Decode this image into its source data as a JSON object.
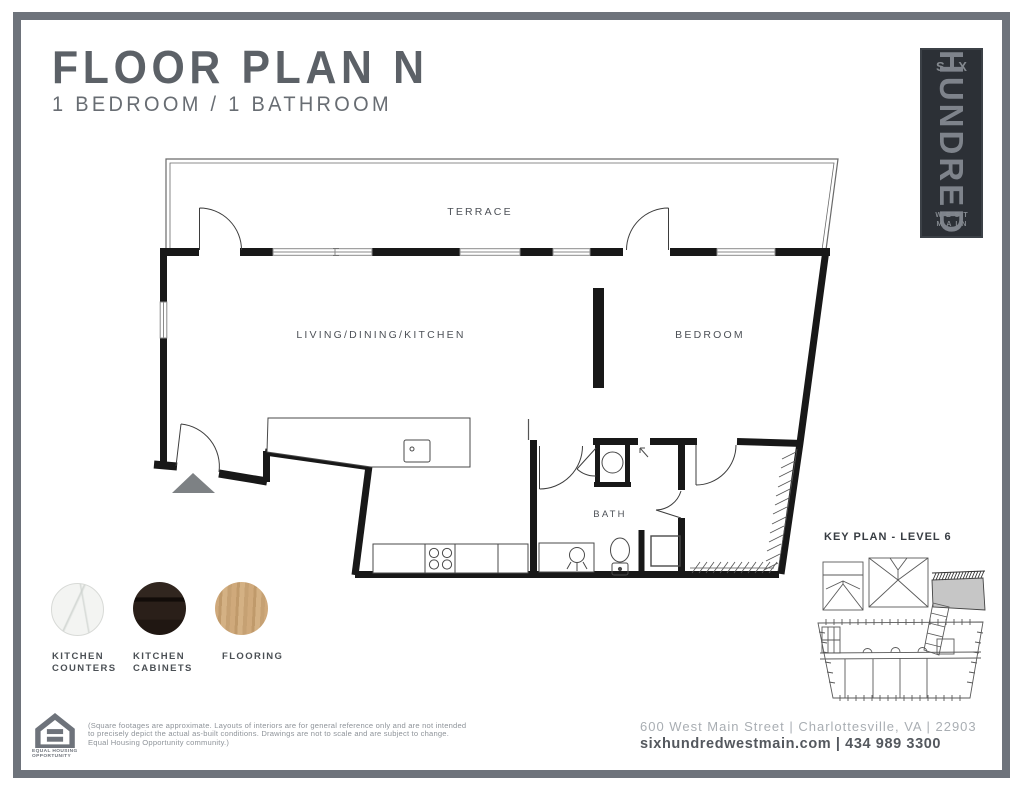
{
  "page": {
    "title": "FLOOR PLAN N",
    "subtitle": "1 BEDROOM / 1 BATHROOM"
  },
  "logo": {
    "top": "SIX",
    "middle": "HUNDRED",
    "bottom_line1": "WEST",
    "bottom_line2": "MAIN"
  },
  "plan": {
    "rooms": {
      "terrace": "TERRACE",
      "living": "LIVING/DINING/KITCHEN",
      "bedroom": "BEDROOM",
      "bath": "BATH"
    }
  },
  "key_plan": {
    "title": "KEY PLAN - LEVEL 6"
  },
  "swatches": [
    {
      "name": "kitchen-counters",
      "label_lines": [
        "KITCHEN",
        "COUNTERS"
      ],
      "color": "#f3f4f2"
    },
    {
      "name": "kitchen-cabinets",
      "label_lines": [
        "KITCHEN",
        "CABINETS"
      ],
      "color": "#241c17"
    },
    {
      "name": "flooring",
      "label_lines": [
        "FLOORING"
      ],
      "color": "#c8a377"
    }
  ],
  "footer": {
    "equal_housing_lines": [
      "EQUAL HOUSING",
      "OPPORTUNITY"
    ],
    "disclaimer_lines": [
      "(Square footages are approximate. Layouts of interiors are for general reference only and are not intended",
      "to precisely depict the actual as-built conditions. Drawings are not to scale and are subject to change.",
      "Equal Housing Opportunity community.)"
    ],
    "address_line": "600 West Main Street | Charlottesville, VA | 22903",
    "contact_line": "sixhundredwestmain.com | 434 989 3300"
  },
  "colors": {
    "frame": "#6e737b",
    "wall": "#181818",
    "title": "#5c6167",
    "label": "#4d5157",
    "logo_bg": "#2c3036",
    "keyplan_highlight": "#c6c6c6",
    "entry_arrow": "#7d8184"
  }
}
